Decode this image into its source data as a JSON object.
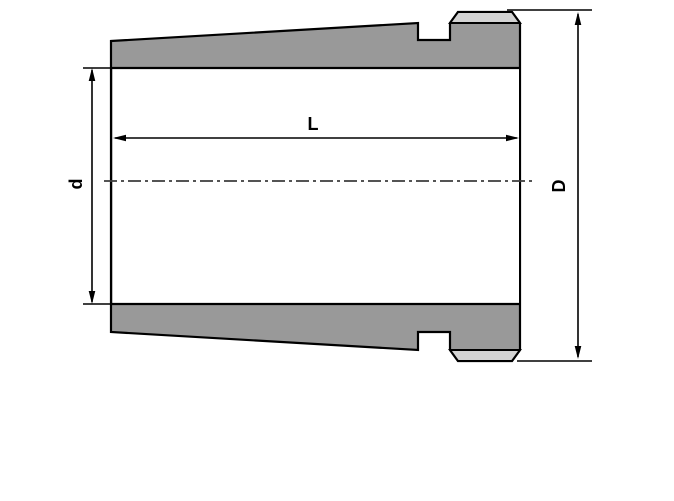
{
  "diagram": {
    "name": "adapter-sleeve-cross-section-drawing",
    "labels": {
      "length": "L",
      "bore_diameter": "d",
      "outer_diameter": "D"
    }
  },
  "colors": {
    "background": "#ffffff",
    "outline": "#000000",
    "section_fill": "#999999",
    "collar_fill": "#d3d3d3",
    "dimension": "#000000",
    "centerline": "#3d3d3d"
  }
}
